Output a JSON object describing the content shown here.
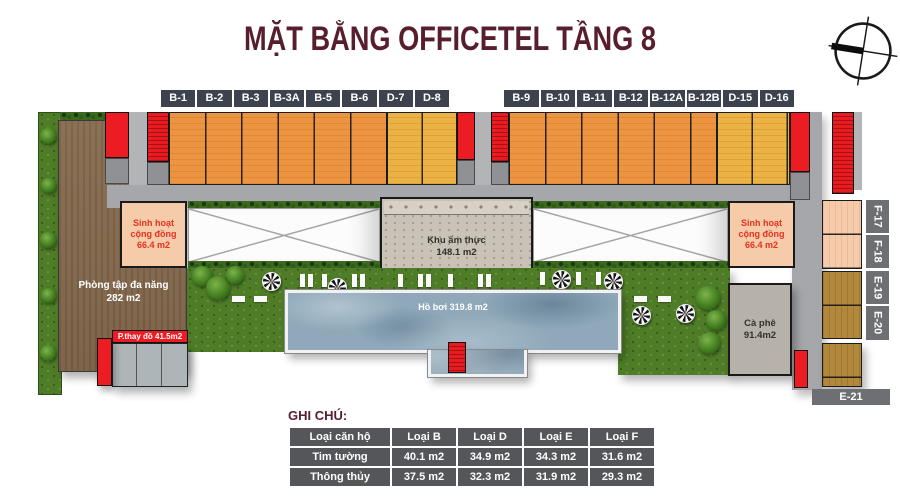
{
  "title": "MẶT BẰNG OFFICETEL TẦNG 8",
  "icons": {
    "compass": "compass-rose",
    "umbrella": "pool-umbrella-pinwheel",
    "tree": "tree-canopy"
  },
  "units": {
    "top_left": [
      "B-1",
      "B-2",
      "B-3",
      "B-3A",
      "B-5",
      "B-6",
      "D-7",
      "D-8"
    ],
    "top_right": [
      "B-9",
      "B-10",
      "B-11",
      "B-12",
      "B-12A",
      "B-12B",
      "D-15",
      "D-16"
    ],
    "right_side": [
      "F-17",
      "F-18",
      "E-19",
      "E-20"
    ],
    "bottom_right": "E-21"
  },
  "rooms": {
    "community_left": {
      "line1": "Sinh hoạt",
      "line2": "cộng đồng",
      "area": "66.4 m2"
    },
    "community_right": {
      "line1": "Sinh hoạt",
      "line2": "cộng đồng",
      "area": "66.4 m2"
    },
    "gym": {
      "name": "Phòng tập đa năng",
      "area": "282 m2"
    },
    "changing_room": {
      "label": "P.thay đồ 41.5m2"
    },
    "food_court": {
      "name": "Khu ẩm thực",
      "area": "148.1 m2"
    },
    "pool": {
      "label": "Hồ bơi 319.8 m2"
    },
    "cafe": {
      "name": "Cà phê",
      "area": "91.4m2"
    }
  },
  "legend": {
    "heading": "GHI CHÚ:",
    "columns": [
      "Loại căn hộ",
      "Loại B",
      "Loại D",
      "Loại E",
      "Loại F"
    ],
    "rows": [
      {
        "label": "Tim tường",
        "values": [
          "40.1 m2",
          "34.9 m2",
          "34.3 m2",
          "31.6 m2"
        ]
      },
      {
        "label": "Thông thủy",
        "values": [
          "37.5 m2",
          "32.3 m2",
          "31.9 m2",
          "29.3 m2"
        ]
      }
    ]
  },
  "colors": {
    "title_maroon": "#571f2d",
    "badge_dark": "#3d434e",
    "badge_gray": "#6e6f72",
    "unit_orange": "#ed9440",
    "unit_gold": "#ecb243",
    "unit_dark_gold": "#b2893c",
    "unit_peach": "#f5cbaa",
    "core_red": "#ec1c23",
    "corridor_gray": "#a5a7aa",
    "lawn_green": "#4f7d27",
    "pool_blue": "#8fa9ba",
    "table_gray": "#545659"
  }
}
